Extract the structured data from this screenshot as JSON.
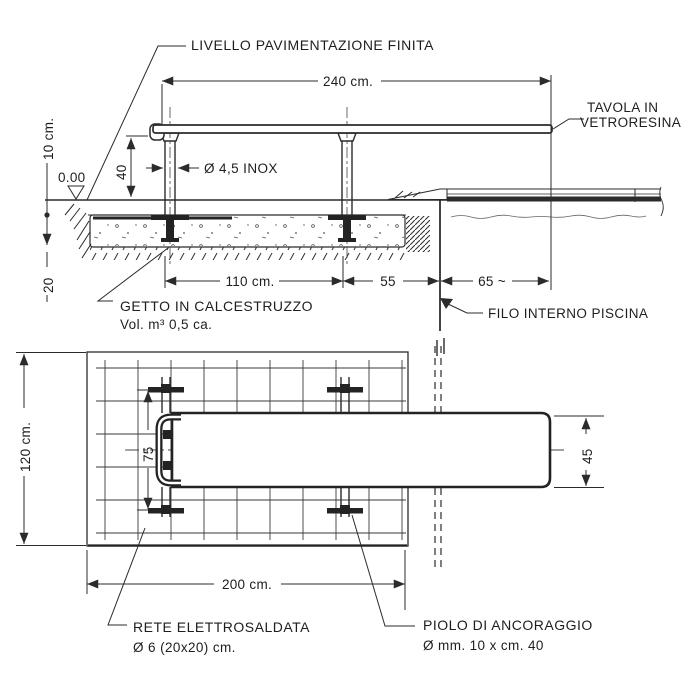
{
  "drawing": {
    "section": {
      "labels": {
        "pavement_level": "LIVELLO PAVIMENTAZIONE FINITA",
        "board_line1": "TAVOLA IN",
        "board_line2": "VETRORESINA",
        "post_spec": "Ø 4,5 INOX",
        "level_zero": "0.00",
        "concrete_line1": "GETTO IN CALCESTRUZZO",
        "concrete_line2": "Vol. m³ 0,5 ca.",
        "pool_edge": "FILO INTERNO PISCINA"
      },
      "dims": {
        "board_length": "240 cm.",
        "pavement_thickness": "10 cm.",
        "rail_height": "40",
        "concrete_depth": "20",
        "anchor_spacing": "110 cm.",
        "anchor_to_pool": "55",
        "overhang": "65 ~"
      }
    },
    "plan": {
      "labels": {
        "mesh_line1": "RETE  ELETTROSALDATA",
        "mesh_line2": "Ø 6 (20x20) cm.",
        "anchor_line1": "PIOLO DI ANCORAGGIO",
        "anchor_line2": "Ø mm. 10 x cm. 40"
      },
      "dims": {
        "slab_width": "120 cm.",
        "feet_spacing": "75",
        "board_width": "45",
        "slab_length": "200 cm."
      }
    },
    "colors": {
      "line": "#2b2b2b",
      "background": "#ffffff"
    }
  }
}
